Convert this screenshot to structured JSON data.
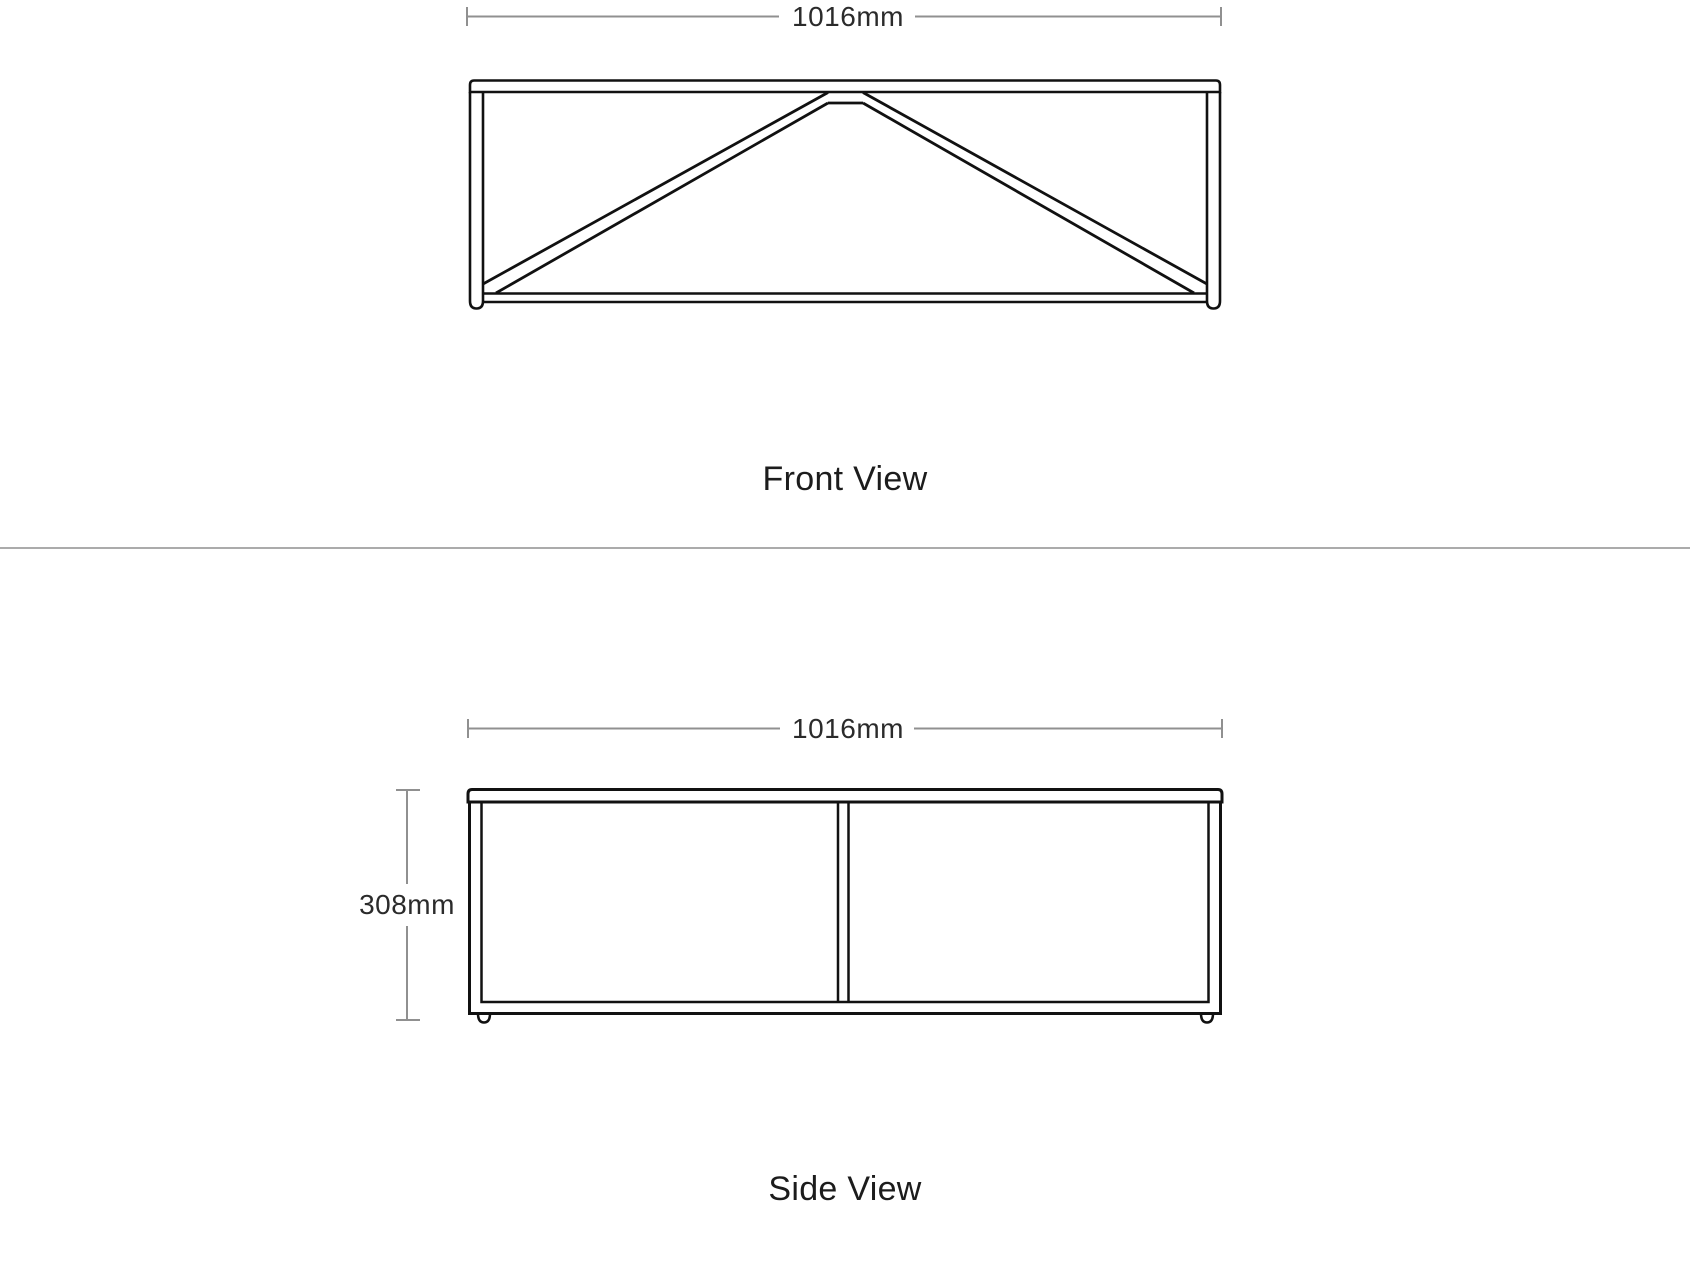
{
  "front_view": {
    "title": "Front View",
    "width_dim": "1016mm"
  },
  "side_view": {
    "title": "Side View",
    "width_dim": "1016mm",
    "height_dim": "308mm"
  },
  "colors": {
    "drawing_line": "#111111",
    "dimension_line": "#909090",
    "dimension_text": "#2b2b2b",
    "label_text": "#1c1c1c",
    "divider": "#ababab",
    "background": "#ffffff"
  }
}
